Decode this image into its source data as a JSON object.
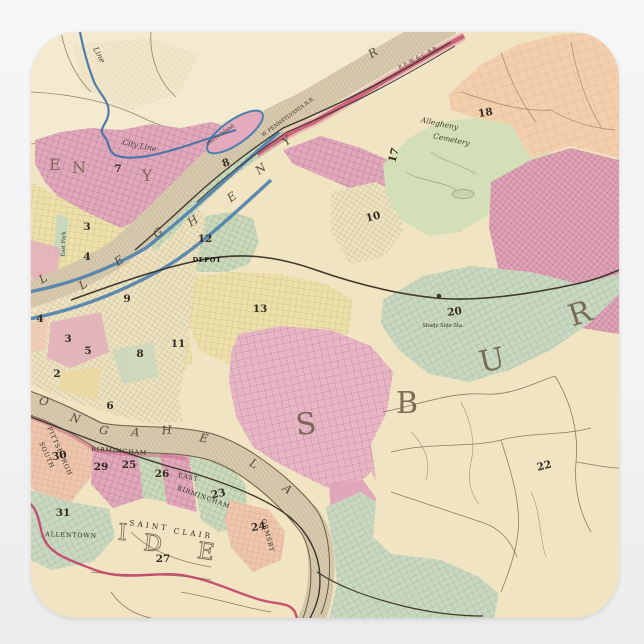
{
  "product": {
    "type": "square-sticker",
    "shape": "rounded-square",
    "background_color": "#f2f2f3",
    "subject": "vintage-map-of-pittsburgh-and-allegheny"
  },
  "palette": {
    "map_base": "#f0e4c2",
    "township_light": "#f4ebd2",
    "ward_pink": "#e1a8bb",
    "ward_pink_light": "#e7b5c4",
    "ward_green": "#cbd9bb",
    "ward_green_gray": "#c9d8c0",
    "ward_yellow": "#eee0ab",
    "ward_peach": "#f4cfae",
    "ward_salmon": "#eec5ad",
    "cemetery_green": "#d3dfb6",
    "river_tan": "#d7c9ad",
    "boundary_blue": "#3f6fa6",
    "boundary_red": "#c2406a",
    "rail_dark": "#3e382e",
    "ink": "#332c20"
  },
  "labels": {
    "ward_numbers": [
      {
        "t": "7",
        "x": 87,
        "y": 140,
        "r": 0,
        "cls": "wn"
      },
      {
        "t": "3",
        "x": 56,
        "y": 198,
        "r": 0,
        "cls": "wn"
      },
      {
        "t": "4",
        "x": 56,
        "y": 228,
        "r": 0,
        "cls": "wn"
      },
      {
        "t": "8",
        "x": 196,
        "y": 134,
        "r": -20,
        "cls": "wn"
      },
      {
        "t": "9",
        "x": 96,
        "y": 270,
        "r": 0,
        "cls": "wn"
      },
      {
        "t": "3",
        "x": 37,
        "y": 310,
        "r": 0,
        "cls": "wn"
      },
      {
        "t": "5",
        "x": 57,
        "y": 322,
        "r": 0,
        "cls": "wn"
      },
      {
        "t": "2",
        "x": 26,
        "y": 345,
        "r": 0,
        "cls": "wn"
      },
      {
        "t": "4",
        "x": 9,
        "y": 290,
        "r": 0,
        "cls": "wn"
      },
      {
        "t": "8",
        "x": 109,
        "y": 325,
        "r": 0,
        "cls": "wn"
      },
      {
        "t": "6",
        "x": 79,
        "y": 377,
        "r": 0,
        "cls": "wn"
      },
      {
        "t": "12",
        "x": 174,
        "y": 210,
        "r": 0,
        "cls": "wn"
      },
      {
        "t": "13",
        "x": 229,
        "y": 280,
        "r": 0,
        "cls": "wn"
      },
      {
        "t": "11",
        "x": 147,
        "y": 315,
        "r": 0,
        "cls": "wn"
      },
      {
        "t": "10",
        "x": 343,
        "y": 188,
        "r": -15,
        "cls": "wn"
      },
      {
        "t": "17",
        "x": 366,
        "y": 124,
        "r": -75,
        "cls": "wn"
      },
      {
        "t": "18",
        "x": 455,
        "y": 84,
        "r": -10,
        "cls": "wn"
      },
      {
        "t": "20",
        "x": 424,
        "y": 283,
        "r": -8,
        "cls": "wn"
      },
      {
        "t": "22",
        "x": 514,
        "y": 437,
        "r": -15,
        "cls": "wn"
      },
      {
        "t": "30",
        "x": 29,
        "y": 427,
        "r": -10,
        "cls": "wn"
      },
      {
        "t": "29",
        "x": 70,
        "y": 438,
        "r": 0,
        "cls": "wn"
      },
      {
        "t": "25",
        "x": 98,
        "y": 436,
        "r": 0,
        "cls": "wn"
      },
      {
        "t": "26",
        "x": 131,
        "y": 445,
        "r": 0,
        "cls": "wn"
      },
      {
        "t": "23",
        "x": 188,
        "y": 465,
        "r": -12,
        "cls": "wn"
      },
      {
        "t": "24",
        "x": 228,
        "y": 498,
        "r": -10,
        "cls": "wn"
      },
      {
        "t": "31",
        "x": 32,
        "y": 484,
        "r": 0,
        "cls": "wn"
      },
      {
        "t": "27",
        "x": 132,
        "y": 530,
        "r": 0,
        "cls": "wn"
      }
    ],
    "district_letters": [
      {
        "t": "S",
        "x": 276,
        "y": 402,
        "r": -6,
        "cls": "big"
      },
      {
        "t": "B",
        "x": 376,
        "y": 381,
        "r": 0,
        "cls": "big"
      },
      {
        "t": "U",
        "x": 463,
        "y": 338,
        "r": -12,
        "cls": "big"
      },
      {
        "t": "R",
        "x": 552,
        "y": 291,
        "r": -18,
        "cls": "big"
      }
    ],
    "district_letters_small": [
      {
        "t": "E",
        "x": 24,
        "y": 138,
        "r": 0,
        "cls": "big2"
      },
      {
        "t": "N",
        "x": 48,
        "y": 141,
        "r": 0,
        "cls": "big2"
      },
      {
        "t": "Y",
        "x": 116,
        "y": 149,
        "r": 0,
        "cls": "big2"
      }
    ],
    "outline_letters": [
      {
        "t": "I",
        "x": 91,
        "y": 508,
        "r": 4,
        "cls": "bigo"
      },
      {
        "t": "D",
        "x": 121,
        "y": 519,
        "r": 6,
        "cls": "bigo"
      },
      {
        "t": "E",
        "x": 174,
        "y": 527,
        "r": 8,
        "cls": "bigo"
      }
    ],
    "river_allegheny": [
      {
        "t": "L",
        "x": 14,
        "y": 250,
        "r": -30,
        "cls": "riv"
      },
      {
        "t": "L",
        "x": 54,
        "y": 256,
        "r": -32,
        "cls": "riv"
      },
      {
        "t": "E",
        "x": 90,
        "y": 232,
        "r": -33,
        "cls": "riv"
      },
      {
        "t": "G",
        "x": 129,
        "y": 204,
        "r": -34,
        "cls": "riv"
      },
      {
        "t": "H",
        "x": 164,
        "y": 192,
        "r": -35,
        "cls": "riv"
      },
      {
        "t": "E",
        "x": 203,
        "y": 168,
        "r": -36,
        "cls": "riv"
      },
      {
        "t": "N",
        "x": 232,
        "y": 140,
        "r": -37,
        "cls": "riv"
      },
      {
        "t": "Y",
        "x": 258,
        "y": 112,
        "r": -38,
        "cls": "riv"
      },
      {
        "t": "R",
        "x": 344,
        "y": 24,
        "r": -33,
        "cls": "riv"
      }
    ],
    "river_monongahela": [
      {
        "t": "O",
        "x": 12,
        "y": 373,
        "r": 14,
        "cls": "riv"
      },
      {
        "t": "N",
        "x": 43,
        "y": 390,
        "r": 18,
        "cls": "riv"
      },
      {
        "t": "G",
        "x": 72,
        "y": 402,
        "r": 14,
        "cls": "riv"
      },
      {
        "t": "A",
        "x": 104,
        "y": 404,
        "r": 6,
        "cls": "riv"
      },
      {
        "t": "H",
        "x": 136,
        "y": 402,
        "r": -4,
        "cls": "riv"
      },
      {
        "t": "E",
        "x": 172,
        "y": 410,
        "r": 12,
        "cls": "riv"
      },
      {
        "t": "L",
        "x": 221,
        "y": 435,
        "r": 28,
        "cls": "riv"
      },
      {
        "t": "A",
        "x": 254,
        "y": 460,
        "r": 38,
        "cls": "riv"
      }
    ],
    "places": [
      {
        "t": "Allegheny",
        "x": 408,
        "y": 94,
        "r": 12,
        "cls": "smi"
      },
      {
        "t": "Cemetery",
        "x": 420,
        "y": 110,
        "r": 12,
        "cls": "smi"
      },
      {
        "t": "East Park",
        "x": 34,
        "y": 212,
        "r": -88,
        "cls": "smt"
      },
      {
        "t": "DEPOT",
        "x": 176,
        "y": 230,
        "r": 0,
        "cls": "smb"
      },
      {
        "t": "Shady Side Sta.",
        "x": 412,
        "y": 295,
        "r": 0,
        "cls": "smt"
      },
      {
        "t": "BIRMINGHAM",
        "x": 88,
        "y": 421,
        "r": 4,
        "cls": "sm"
      },
      {
        "t": "EAST",
        "x": 157,
        "y": 447,
        "r": 12,
        "cls": "sm"
      },
      {
        "t": "BIRMINGHAM",
        "x": 172,
        "y": 467,
        "r": 20,
        "cls": "sm"
      },
      {
        "t": "ALLENTOWN",
        "x": 40,
        "y": 505,
        "r": 2,
        "cls": "sm"
      },
      {
        "t": "SAINT",
        "x": 118,
        "y": 496,
        "r": 8,
        "cls": "smsp"
      },
      {
        "t": "CLAIR",
        "x": 162,
        "y": 504,
        "r": 8,
        "cls": "smsp"
      },
      {
        "t": "SOUTH",
        "x": 14,
        "y": 424,
        "r": 66,
        "cls": "sm"
      },
      {
        "t": "PITTSBURGH",
        "x": 27,
        "y": 420,
        "r": 66,
        "cls": "sm"
      },
      {
        "t": "ORMSBY",
        "x": 235,
        "y": 504,
        "r": 75,
        "cls": "sm"
      },
      {
        "t": "Herrs Island",
        "x": 190,
        "y": 104,
        "r": -35,
        "cls": "smt"
      },
      {
        "t": "City Line",
        "x": 108,
        "y": 116,
        "r": 12,
        "cls": "smi"
      },
      {
        "t": "Line",
        "x": 66,
        "y": 24,
        "r": 62,
        "cls": "smi"
      },
      {
        "t": "W. PENNSYLVANIA R.R.",
        "x": 258,
        "y": 86,
        "r": -36,
        "cls": "smt"
      },
      {
        "t": "P. F. W. & C. R.R.",
        "x": 388,
        "y": 27,
        "r": -28,
        "cls": "smt"
      }
    ]
  }
}
